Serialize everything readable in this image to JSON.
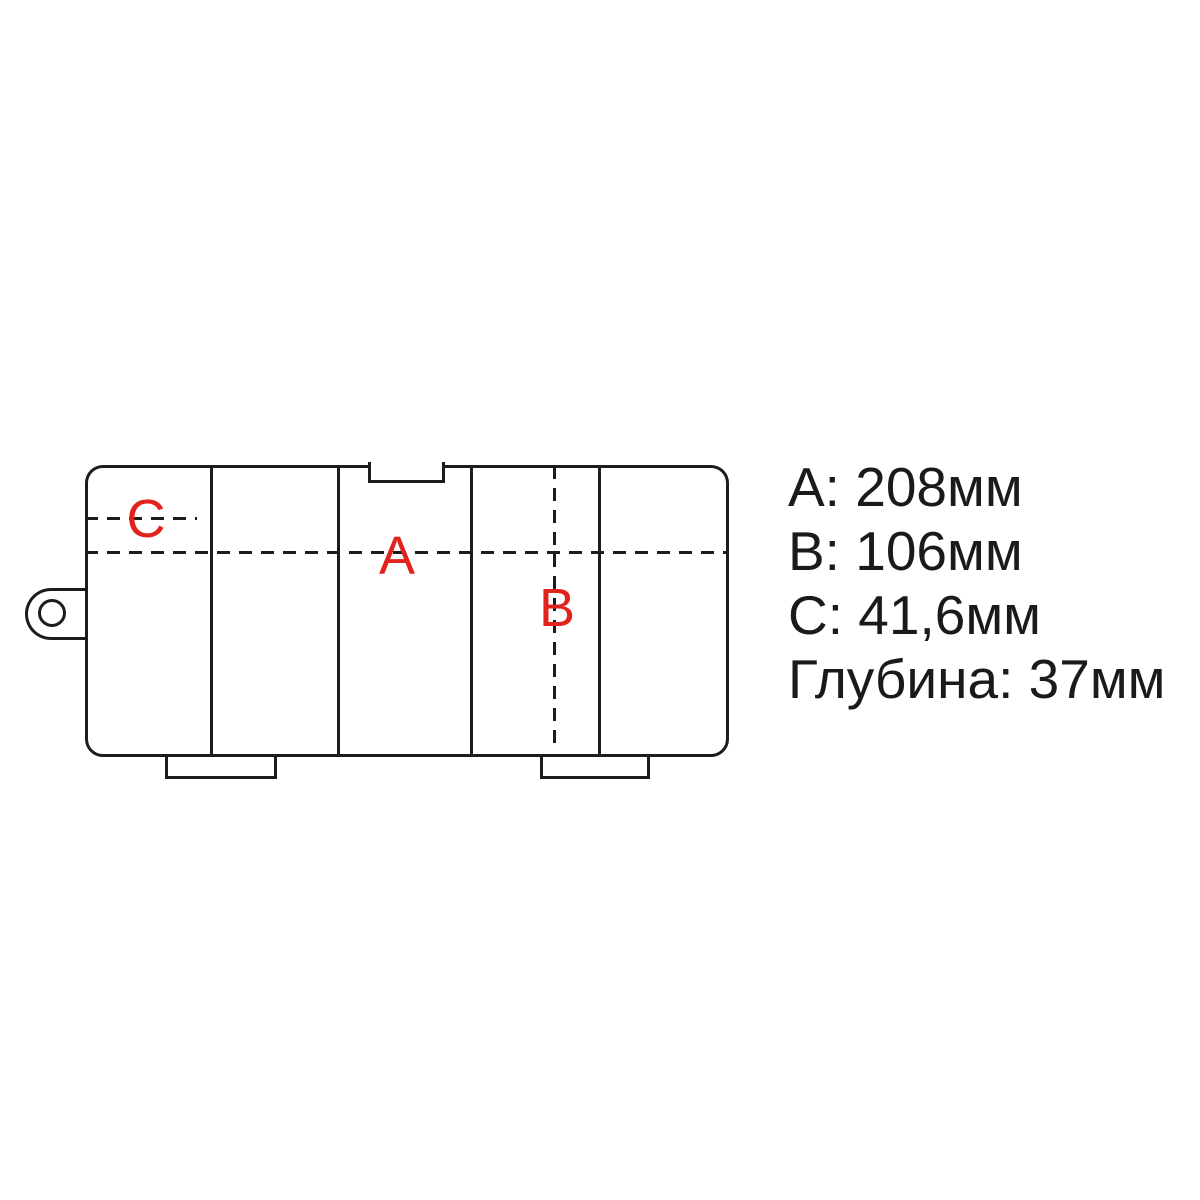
{
  "diagram": {
    "label_a": "A",
    "label_b": "B",
    "label_c": "C"
  },
  "specs": {
    "lines": [
      "A: 208мм",
      "B: 106мм",
      "C: 41,6мм",
      "Глубина: 37мм"
    ]
  },
  "colors": {
    "line": "#1c1c1c",
    "label_red": "#e2231d",
    "background": "#ffffff",
    "text": "#1a1a1a"
  }
}
